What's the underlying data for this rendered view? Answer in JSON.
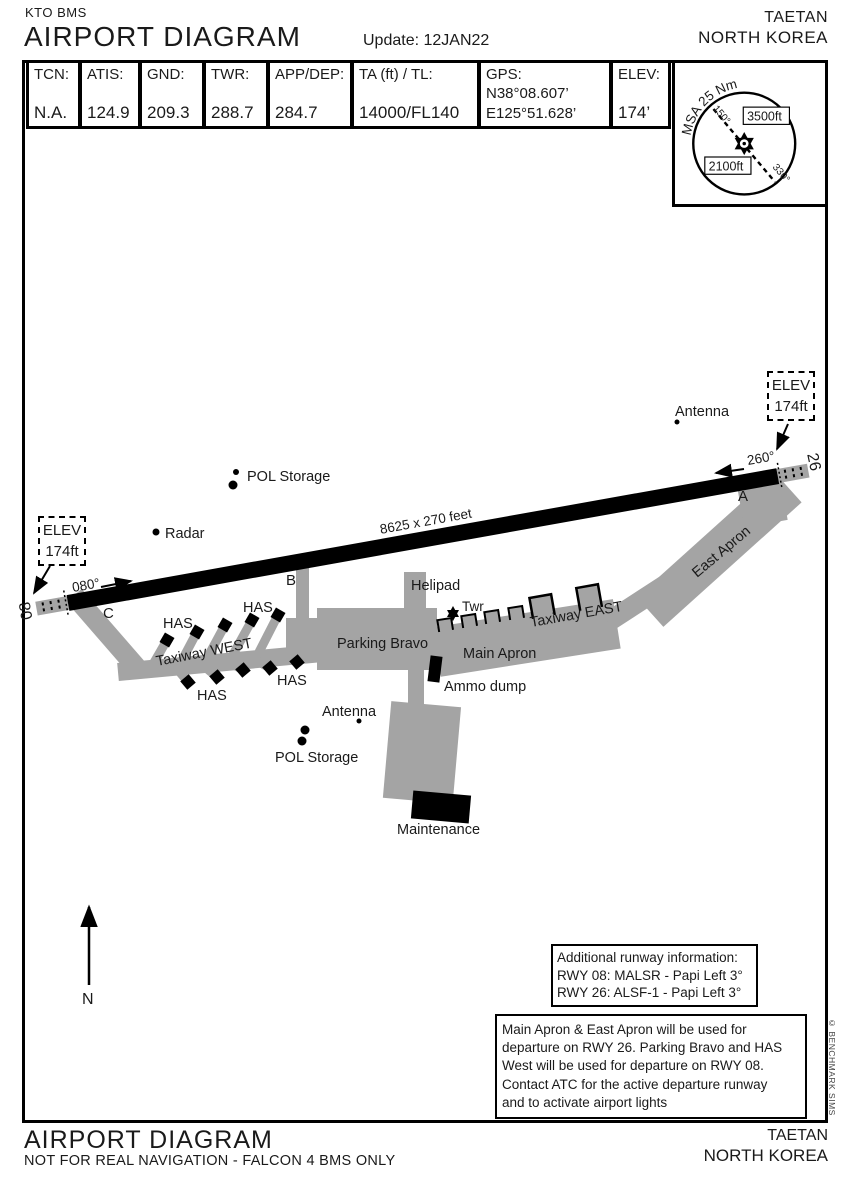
{
  "header": {
    "code": "KTO BMS",
    "title": "AIRPORT DIAGRAM",
    "update": "Update: 12JAN22",
    "city": "TAETAN",
    "country": "NORTH KOREA"
  },
  "info_table": {
    "cells": [
      {
        "label": "TCN:",
        "value": "N.A."
      },
      {
        "label": "ATIS:",
        "value": "124.9"
      },
      {
        "label": "GND:",
        "value": "209.3"
      },
      {
        "label": "TWR:",
        "value": "288.7"
      },
      {
        "label": "APP/DEP:",
        "value": "284.7"
      },
      {
        "label": "TA (ft) / TL:",
        "value": "14000/FL140"
      },
      {
        "label": "GPS:",
        "value": "N38°08.607’",
        "value2": "E125°51.628’"
      },
      {
        "label": "ELEV:",
        "value": "174’"
      }
    ]
  },
  "msa": {
    "title": "MSA 25 Nm",
    "alt_high": "3500ft",
    "alt_low": "2100ft",
    "bearing_1": "150°",
    "bearing_2": "330°"
  },
  "diagram": {
    "runway": {
      "size_label": "8625 x 270 feet",
      "id_08": "08",
      "id_26": "26",
      "hdg_08": "080°",
      "hdg_26": "260°"
    },
    "elev_box": {
      "line1": "ELEV",
      "line2": "174ft"
    },
    "labels": {
      "has": "HAS",
      "taxiway_west": "Taxiway WEST",
      "taxiway_east": "Taxiway EAST",
      "parking_bravo": "Parking Bravo",
      "main_apron": "Main Apron",
      "east_apron": "East Apron",
      "helipad": "Helipad",
      "tower": "Twr",
      "ammo_dump": "Ammo dump",
      "maintenance": "Maintenance",
      "radar": "Radar",
      "pol_storage": "POL Storage",
      "antenna": "Antenna",
      "taxiway_a": "A",
      "taxiway_b": "B",
      "taxiway_c": "C",
      "north": "N"
    }
  },
  "notes": {
    "runway_info_lines": [
      "Additional runway information:",
      "RWY 08: MALSR - Papi Left 3°",
      "RWY 26: ALSF-1 - Papi Left 3°"
    ],
    "departure_lines": [
      "Main Apron & East Apron will be used for",
      "departure on RWY 26. Parking Bravo and HAS",
      "West will be used for departure on RWY 08.",
      "Contact ATC for the active departure runway",
      "and to activate airport lights"
    ]
  },
  "footer": {
    "title": "AIRPORT DIAGRAM",
    "subtitle": "NOT FOR REAL NAVIGATION - FALCON 4 BMS ONLY",
    "city": "TAETAN",
    "country": "NORTH KOREA"
  },
  "copyright": "© BENCHMARK SIMS",
  "colors": {
    "pavement": "#a4a4a4",
    "ink": "#000000"
  }
}
